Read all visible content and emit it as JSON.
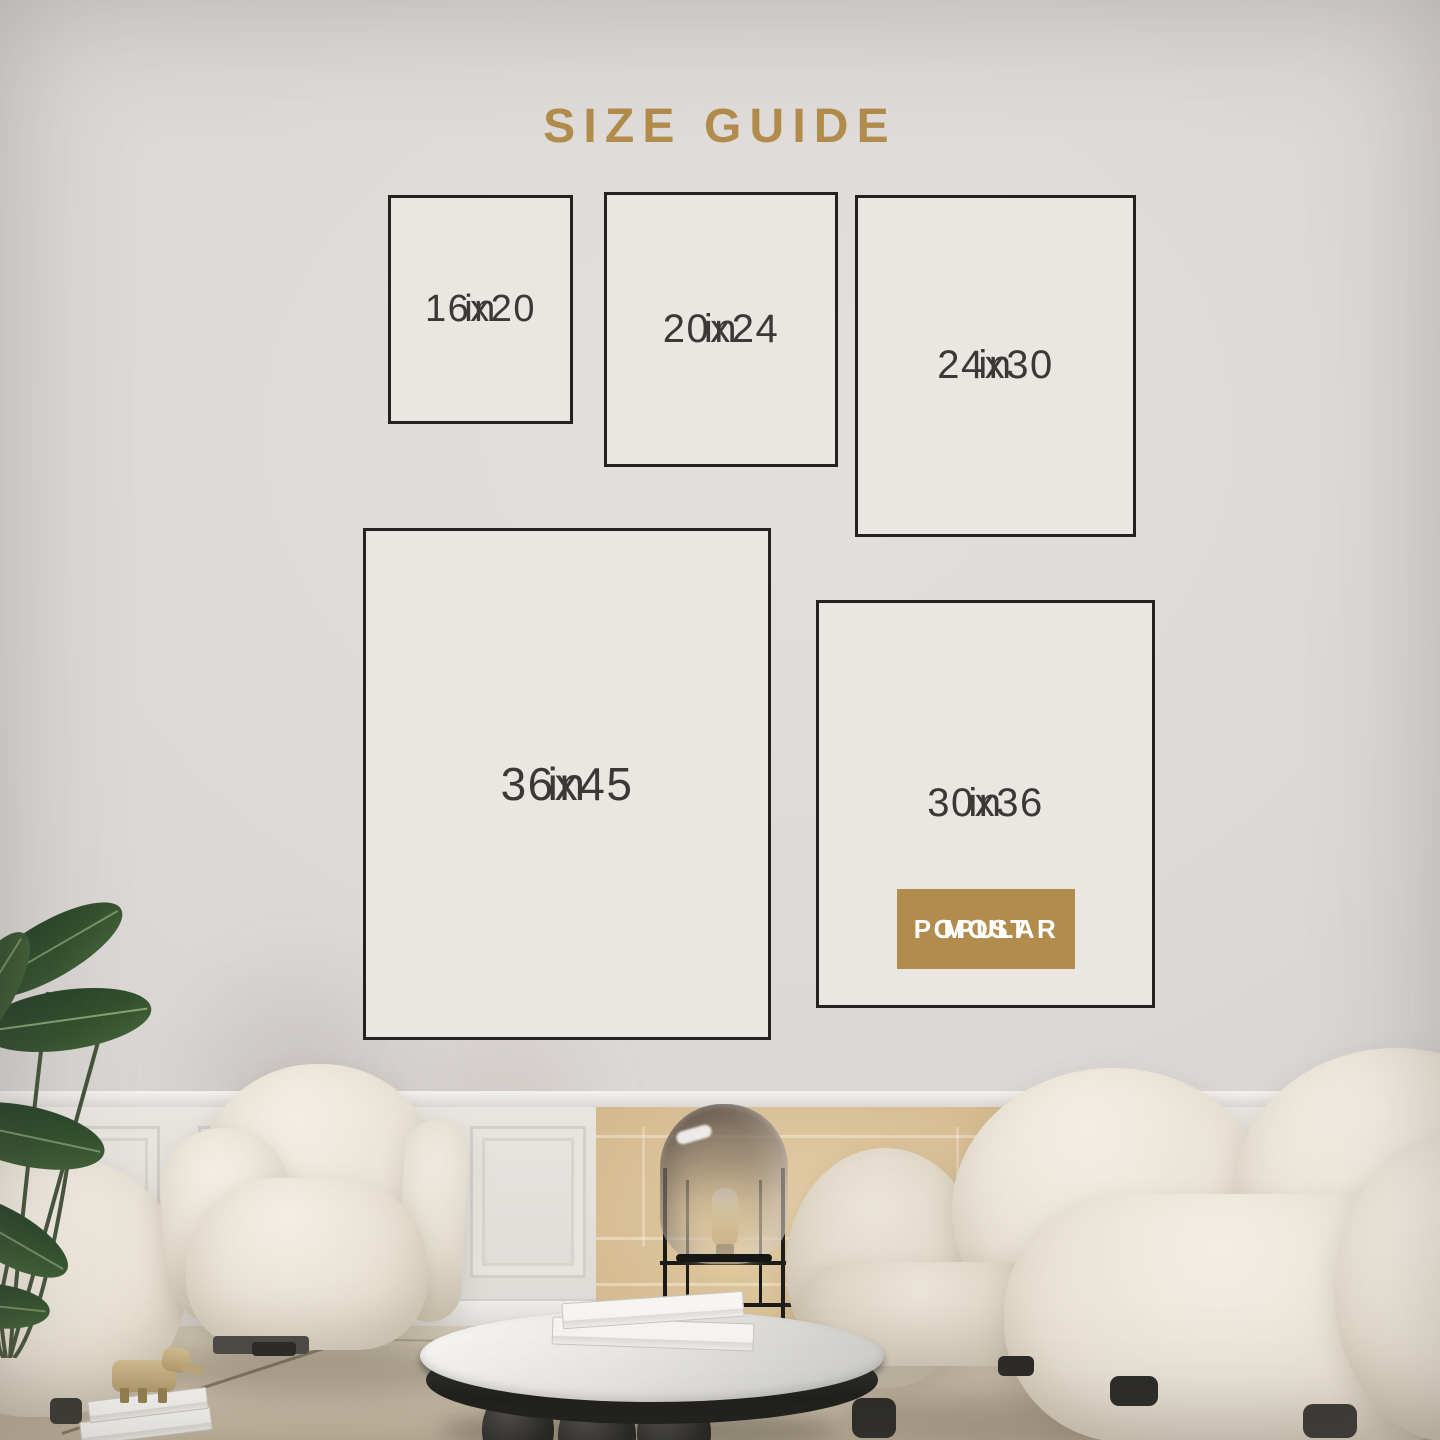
{
  "title": "SIZE GUIDE",
  "sizes": [
    {
      "dimensions": "16x20",
      "unit": "in"
    },
    {
      "dimensions": "20x24",
      "unit": "in"
    },
    {
      "dimensions": "24x30",
      "unit": "in"
    },
    {
      "dimensions": "36x45",
      "unit": "in"
    },
    {
      "dimensions": "30x36",
      "unit": "in",
      "badge": {
        "line1": "MOST",
        "line2": "POPULAR"
      }
    }
  ],
  "colors": {
    "accent_gold": "#b18c4c",
    "box_fill": "#eae6e1",
    "box_border": "#23221e",
    "size_text": "#3a3936",
    "badge_text": "#ffffff",
    "wall": "#dbd7d5",
    "wainscot_beige": "#d4ba8f",
    "floor": "#cfc5b2",
    "fabric_cream": "#ece6da",
    "leaf_green": "#2f4c31",
    "lamp_glow": "#f5dfae",
    "table_top": "#eceae7",
    "table_base": "#1c1c1a"
  }
}
